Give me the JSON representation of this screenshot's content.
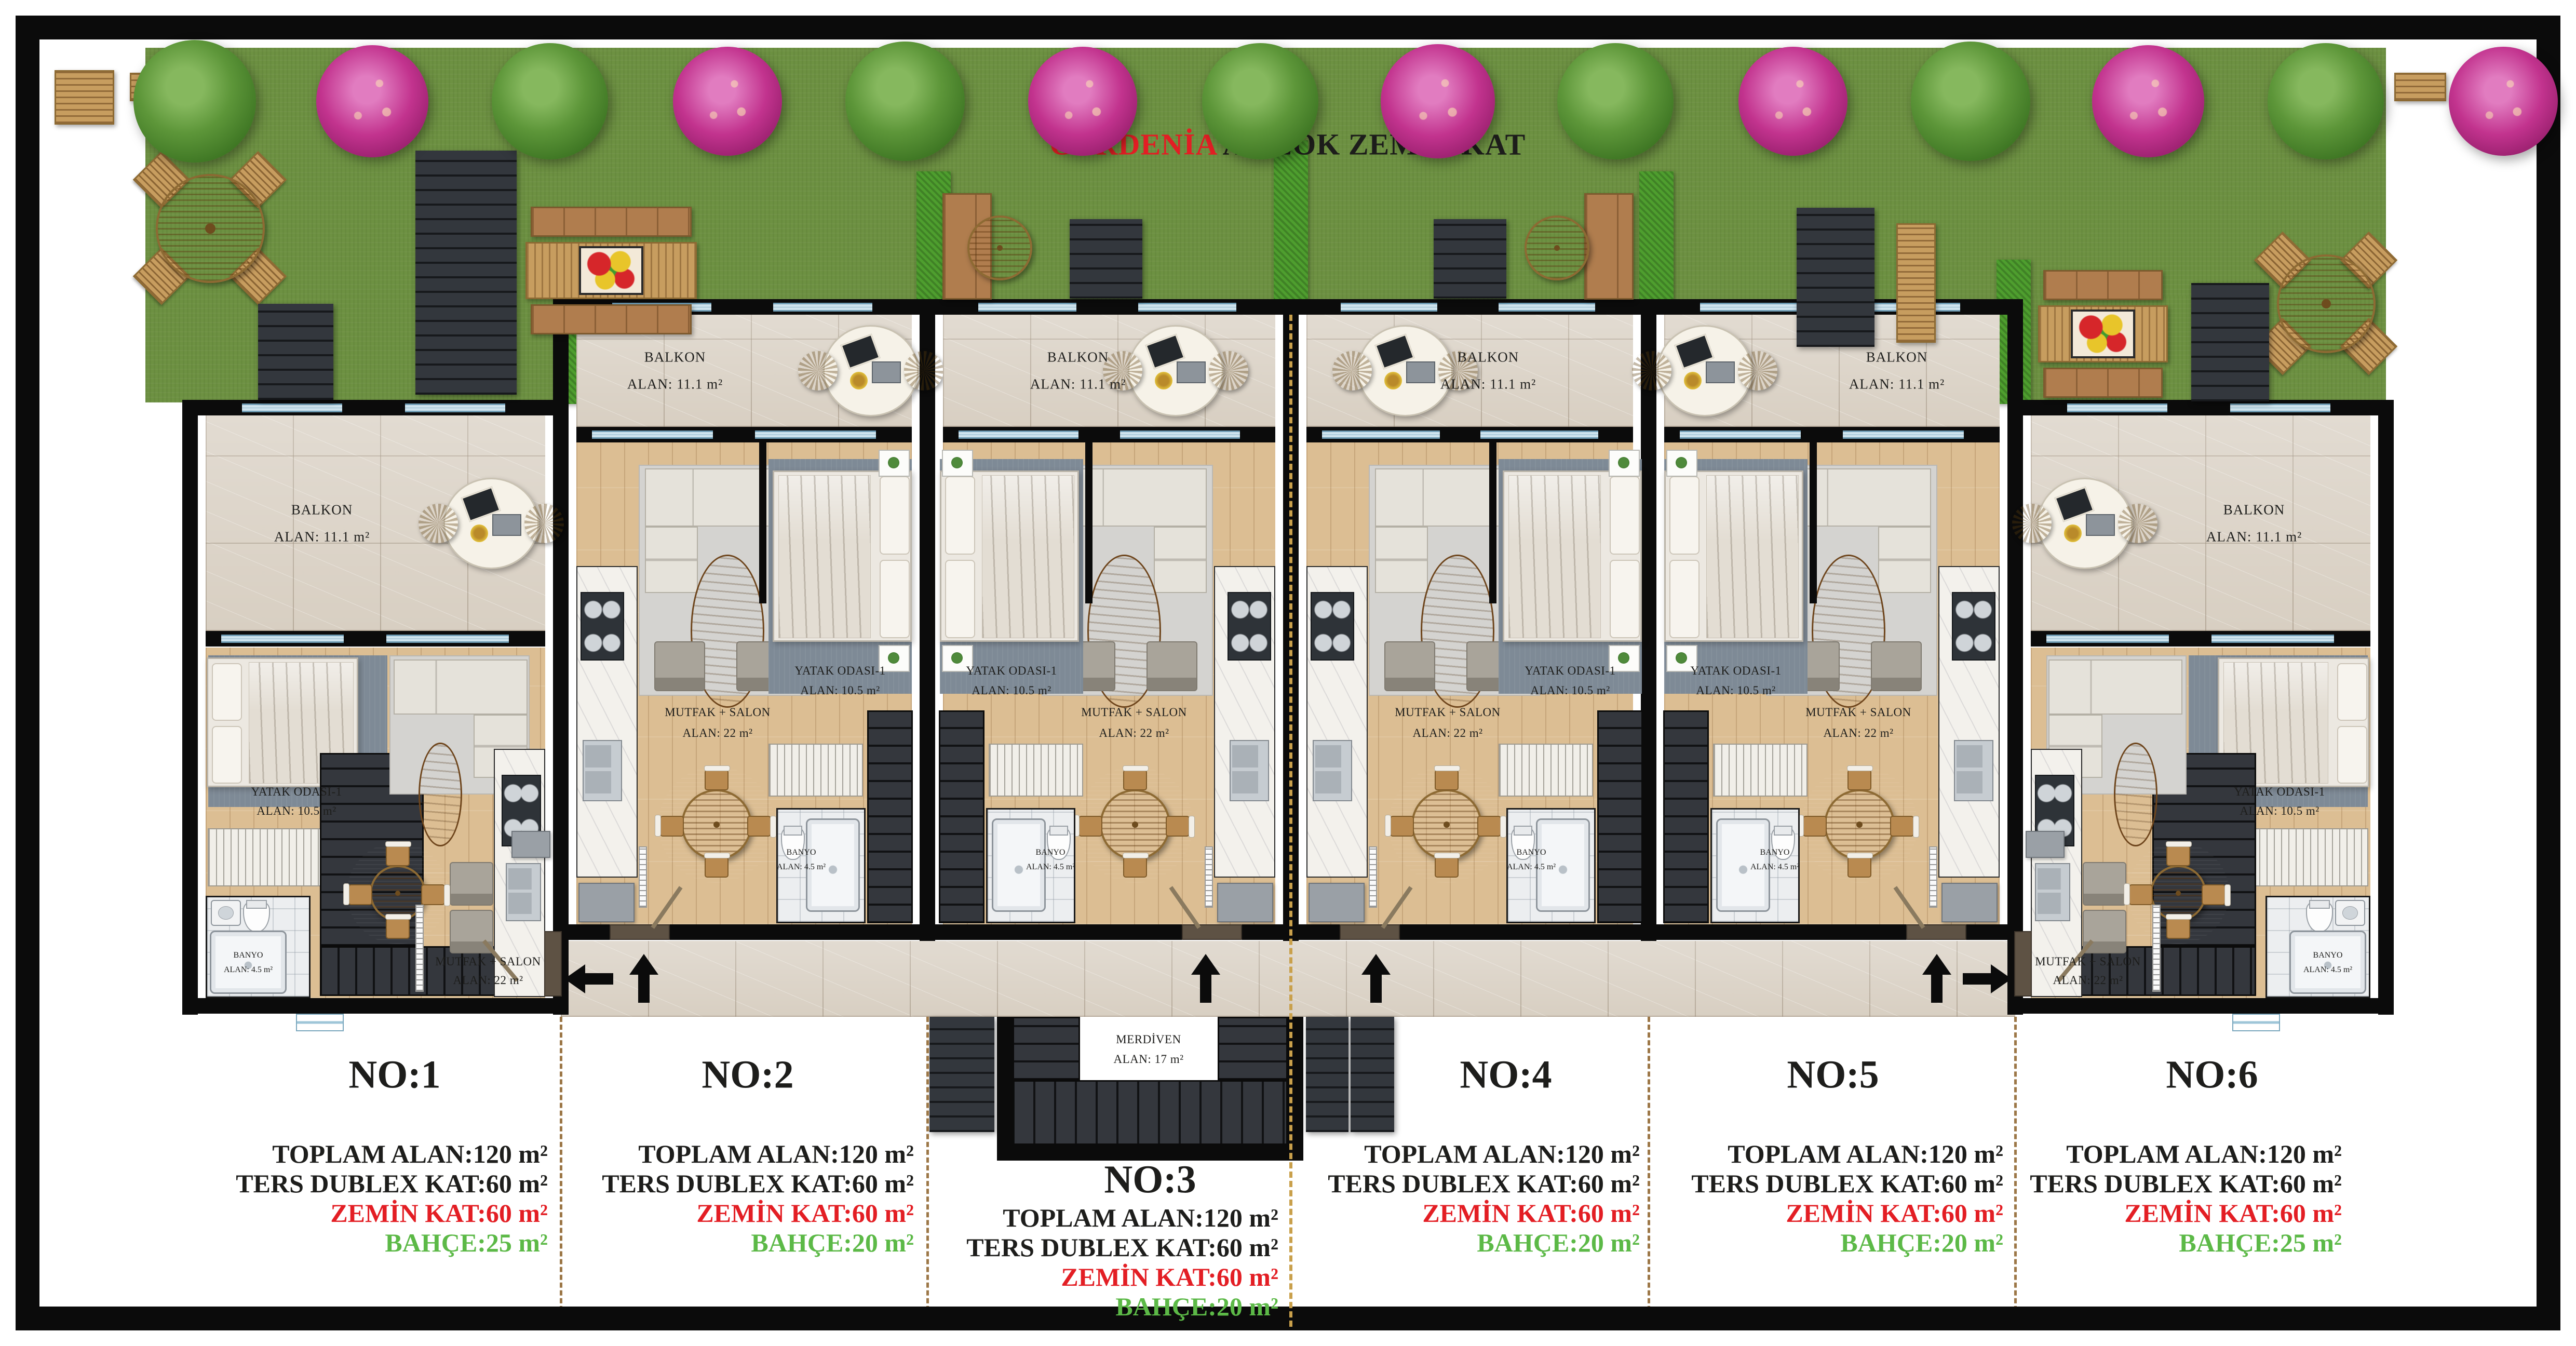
{
  "title": {
    "brand": "GARDENİA",
    "block": " A BLOK ZEMİN KAT"
  },
  "rooms": {
    "balkon": {
      "name": "BALKON",
      "area": "ALAN: 11.1 m²"
    },
    "yatak": {
      "name": "YATAK ODASI-1",
      "area": "ALAN: 10.5 m²"
    },
    "salon": {
      "name": "MUTFAK + SALON",
      "area": "ALAN: 22 m²"
    },
    "banyo": {
      "name": "BANYO",
      "area": "ALAN: 4.5 m²"
    },
    "merdiven": {
      "name": "MERDİVEN",
      "area": "ALAN: 17 m²"
    }
  },
  "units": [
    {
      "no": "NO:1",
      "lines": [
        {
          "text": "TOPLAM ALAN:120 m²"
        },
        {
          "text": "TERS DUBLEX KAT:60 m²"
        },
        {
          "text": "ZEMİN KAT:60 m²"
        },
        {
          "text": "BAHÇE:25 m²"
        }
      ]
    },
    {
      "no": "NO:2",
      "lines": [
        {
          "text": "TOPLAM ALAN:120 m²"
        },
        {
          "text": "TERS DUBLEX KAT:60 m²"
        },
        {
          "text": "ZEMİN KAT:60 m²"
        },
        {
          "text": "BAHÇE:20 m²"
        }
      ]
    },
    {
      "no": "NO:3",
      "lines": [
        {
          "text": "TOPLAM ALAN:120 m²"
        },
        {
          "text": "TERS DUBLEX KAT:60 m²"
        },
        {
          "text": "ZEMİN KAT:60 m²"
        },
        {
          "text": "BAHÇE:20 m²"
        }
      ]
    },
    {
      "no": "NO:4",
      "lines": [
        {
          "text": "TOPLAM ALAN:120 m²"
        },
        {
          "text": "TERS DUBLEX KAT:60 m²"
        },
        {
          "text": "ZEMİN KAT:60 m²"
        },
        {
          "text": "BAHÇE:20 m²"
        }
      ]
    },
    {
      "no": "NO:5",
      "lines": [
        {
          "text": "TOPLAM ALAN:120 m²"
        },
        {
          "text": "TERS DUBLEX KAT:60 m²"
        },
        {
          "text": "ZEMİN KAT:60 m²"
        },
        {
          "text": "BAHÇE:20 m²"
        }
      ]
    },
    {
      "no": "NO:6",
      "lines": [
        {
          "text": "TOPLAM ALAN:120 m²"
        },
        {
          "text": "TERS DUBLEX KAT:60 m²"
        },
        {
          "text": "ZEMİN KAT:60 m²"
        },
        {
          "text": "BAHÇE:25 m²"
        }
      ]
    }
  ],
  "colors": {
    "accent_red": "#e31e24",
    "garden_green": "#5cb947",
    "lawn": "#6d9142",
    "hedge": "#4e9e2e",
    "tile": "#d8cfc2",
    "wood_floor": "#dcbe93",
    "wall": "#0b0b0b"
  }
}
